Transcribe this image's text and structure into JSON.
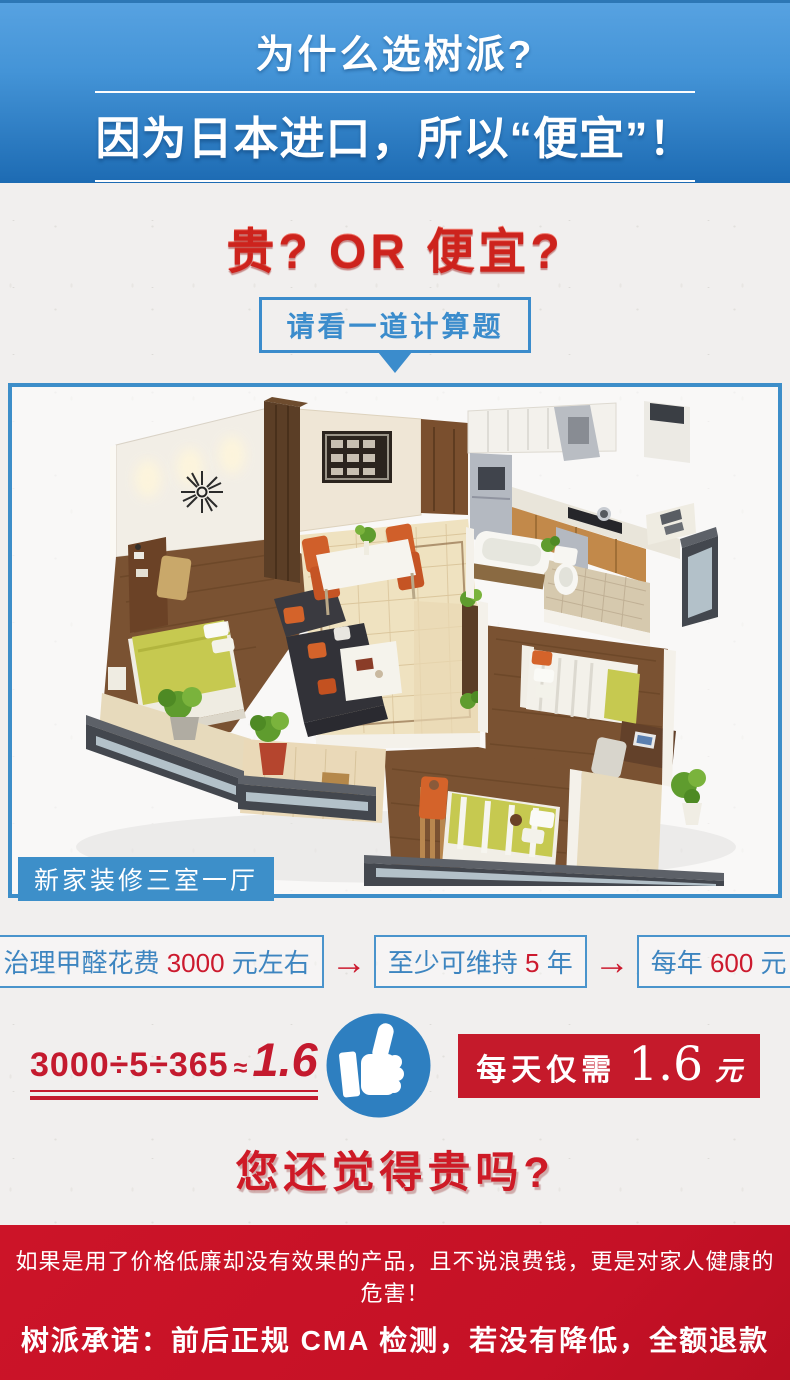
{
  "colors": {
    "header_blue_top": "#57a2e1",
    "header_blue_bottom": "#1d6bb3",
    "accent_blue": "#3b8ccc",
    "step_text_blue": "#3d85c0",
    "highlight_red": "#cc1a2e",
    "banner_red": "#c51126",
    "page_bg": "#f1efee"
  },
  "header": {
    "title": "为什么选树派?",
    "subtitle": "因为日本进口，所以“便宜”！"
  },
  "comparison": {
    "question": "贵?  OR  便宜?",
    "prompt": "请看一道计算题"
  },
  "floor_plan": {
    "label": "新家装修三室一厅",
    "alt": "三室一厅新家装修 3D 户型效果图"
  },
  "calculation": {
    "arrow": "→",
    "steps": [
      {
        "prefix": "治理甲醛花费 ",
        "value": "3000",
        "suffix": " 元左右"
      },
      {
        "prefix": "至少可维持 ",
        "value": "5",
        "suffix": " 年"
      },
      {
        "prefix": "每年 ",
        "value": "600",
        "suffix": " 元"
      }
    ],
    "formula": {
      "expression": "3000÷5÷365",
      "approx": "≈",
      "result": "1.6"
    },
    "daily_cost": {
      "prefix": "每天仅需",
      "value": "1.6",
      "suffix": "元"
    },
    "icons": {
      "approval": "thumbs-up",
      "pointer": "down-triangle"
    }
  },
  "conclusion": {
    "question": "您还觉得贵吗?"
  },
  "banner": {
    "line1": "如果是用了价格低廉却没有效果的产品，且不说浪费钱，更是对家人健康的危害！",
    "line2": "树派承诺：前后正规 CMA 检测，若没有降低，全额退款"
  }
}
